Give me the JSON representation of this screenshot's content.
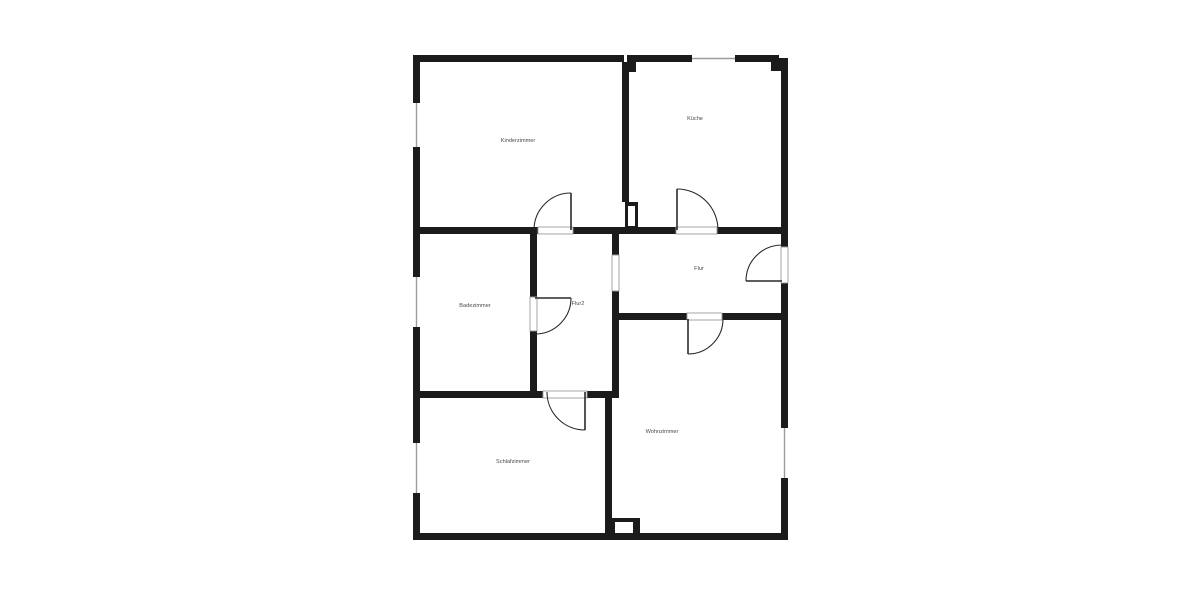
{
  "plan": {
    "type": "apartment-floor-plan",
    "rooms": [
      {
        "name": "Kinderzimmer"
      },
      {
        "name": "Küche"
      },
      {
        "name": "Badezimmer"
      },
      {
        "name": "Flur2"
      },
      {
        "name": "Flur"
      },
      {
        "name": "Schlafzimmer"
      },
      {
        "name": "Wohnzimmer"
      }
    ]
  },
  "colors": {
    "wall": "#1b1b1b",
    "background": "#ffffff",
    "opening_outline": "#9c9c9c",
    "door_arc": "#2a2a2a",
    "label": "#4a4a4a"
  }
}
